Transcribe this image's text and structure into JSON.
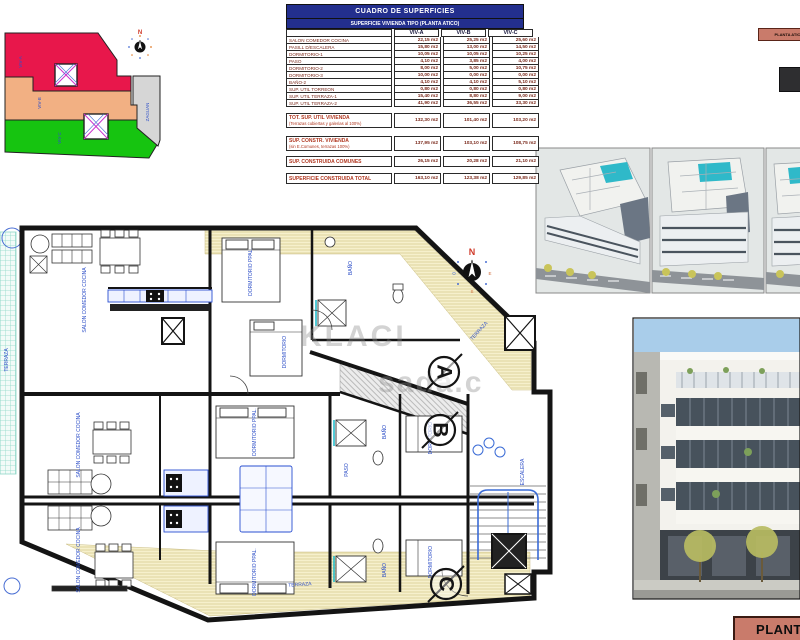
{
  "surface_table": {
    "title": "CUADRO DE SUPERFICIES",
    "subtitle": "SUPERFICIE VIVIENDA TIPO (PLANTA ATICO)",
    "columns": [
      "VIV-A",
      "VIV-B",
      "VIV-C"
    ],
    "rows": [
      {
        "label": "SALON COMEDOR COCINA",
        "a": "22,15 m2",
        "b": "25,25 m2",
        "c": "25,60 m2"
      },
      {
        "label": "PASILL D/ESCALERA",
        "a": "15,80 m2",
        "b": "13,00 m2",
        "c": "14,50 m2"
      },
      {
        "label": "DORMITORIO-1",
        "a": "10,05 m2",
        "b": "10,05 m2",
        "c": "10,25 m2"
      },
      {
        "label": "PASO",
        "a": "4,10 m2",
        "b": "3,85 m2",
        "c": "4,00 m2"
      },
      {
        "label": "DORMITORIO-2",
        "a": "8,00 m2",
        "b": "5,00 m2",
        "c": "10,75 m2"
      },
      {
        "label": "DORMITORIO-3",
        "a": "10,00 m2",
        "b": "0,00 m2",
        "c": "0,00 m2"
      },
      {
        "label": "BAÑO-2",
        "a": "4,10 m2",
        "b": "4,10 m2",
        "c": "5,10 m2"
      },
      {
        "label": "SUP. UTIL TORREON",
        "a": "0,80 m2",
        "b": "0,80 m2",
        "c": "0,80 m2"
      },
      {
        "label": "SUP. UTIL TERRAZA-1",
        "a": "15,40 m2",
        "b": "8,80 m2",
        "c": "9,00 m2"
      },
      {
        "label": "SUP. UTIL TERRAZA-2",
        "a": "41,90 m2",
        "b": "36,55 m2",
        "c": "33,30 m2"
      }
    ],
    "summary": [
      {
        "label": "TOT. SUP. UTIL VIVIENDA",
        "sublabel": "(Terrazas cubiertas y galerias al 100%)",
        "a": "132,30 m2",
        "b": "101,40 m2",
        "c": "103,20 m2"
      },
      {
        "label": "SUP. CONSTR. VIVIENDA",
        "sublabel": "(sin E.Comunes, terrazas 100%)",
        "a": "137,95 m2",
        "b": "103,10 m2",
        "c": "108,75 m2"
      },
      {
        "label": "SUP. CONSTRUIDA COMUNES",
        "sublabel": "",
        "a": "26,15 m2",
        "b": "20,28 m2",
        "c": "21,10 m2"
      },
      {
        "label": "SUPERFICIE CONSTRUIDA TOTAL",
        "sublabel": "",
        "a": "163,10 m2",
        "b": "123,38 m2",
        "c": "129,85 m2"
      }
    ]
  },
  "site_plan": {
    "north_label": "N",
    "areas": [
      {
        "name": "VIV-A"
      },
      {
        "name": "VIV-B"
      },
      {
        "name": "VIV-C"
      },
      {
        "name": "ZAGUAN"
      }
    ]
  },
  "floor_plan": {
    "compass": {
      "n": "N",
      "s": "S",
      "e": "E",
      "o": "O"
    },
    "section_markers": [
      "A",
      "B",
      "C"
    ],
    "watermark": [
      "KLACI",
      "sada.c"
    ],
    "room_labels": {
      "salon": "SALON COMEDOR COCINA",
      "dormitorio_ppal": "DORMITORIO PPAL.",
      "dormitorio": "DORMITORIO",
      "bano": "BAÑO",
      "paso": "PASO",
      "terraza": "TERRAZA",
      "escalera": "ESCALERA"
    }
  },
  "annotations": {
    "mini_tag": "PLANTA ATICO",
    "footer_tag": "PLANTA ATICO"
  },
  "colors": {
    "navy": "#232f8e",
    "table_text": "#7b2a1c",
    "viv_a_red": "#e8174b",
    "viv_b_orange": "#f2b083",
    "viv_c_green": "#16c410",
    "zaguan_gray": "#d6d6d6",
    "plan_label_blue": "#3050c8",
    "terrace_yellow": "#f6f0cc",
    "pool_teal": "#2fb9c9",
    "tag_salmon": "#c97b6b"
  }
}
